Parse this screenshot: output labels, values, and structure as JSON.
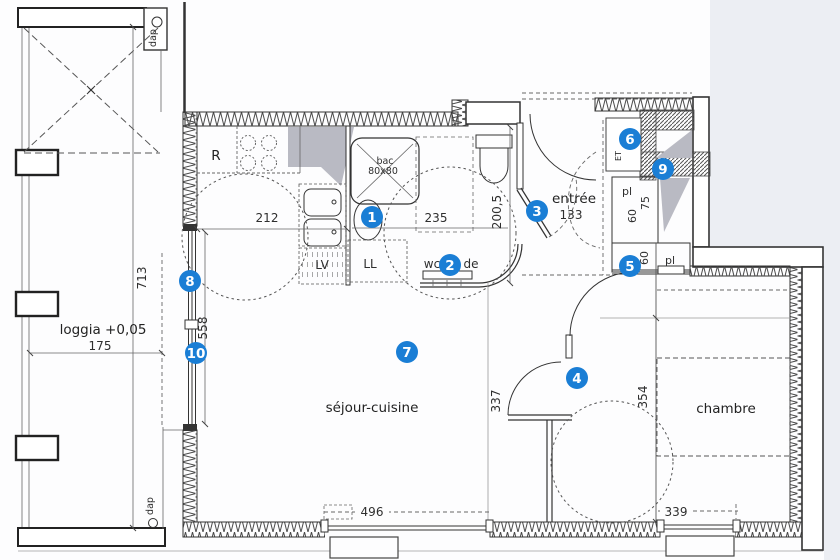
{
  "title": "apartment floor plan with numbered markers",
  "rooms": {
    "sejour_cuisine": "séjour-cuisine",
    "chambre": "chambre",
    "entree": "entrée",
    "entree_dim": "133",
    "loggia": "loggia +0,05",
    "loggia_dim": "175"
  },
  "fixtures": {
    "fridge": "R",
    "shower_line1": "bac",
    "shower_line2": "80x80",
    "dishwasher": "LV",
    "washing_machine": "LL",
    "wc_label_left": "wc",
    "wc_label_right": "de",
    "duct_top": "dap",
    "duct_bottom": "dap",
    "shaft_label": "ET",
    "closet_upper_label": "pl",
    "closet_upper_depth": "75",
    "closet_upper_width": "60",
    "closet_lower_width": "60",
    "closet_lower_label": "pl"
  },
  "dimensions": {
    "kitchen_width": "212",
    "bathroom_width": "235",
    "bathroom_depth": "200,5",
    "loggia_length": "713",
    "glazing_height": "558",
    "sejour_to_wall": "337",
    "chambre_depth": "354",
    "sejour_window": "496",
    "chambre_window": "339"
  },
  "markers": [
    {
      "label": "1"
    },
    {
      "label": "2"
    },
    {
      "label": "3"
    },
    {
      "label": "4"
    },
    {
      "label": "5"
    },
    {
      "label": "6"
    },
    {
      "label": "7"
    },
    {
      "label": "8"
    },
    {
      "label": "9"
    },
    {
      "label": "10"
    }
  ],
  "colors": {
    "marker_blue": "#1a7ed5",
    "wall_line": "#333333",
    "duct_gray": "#b9bac3",
    "outside_tint": "#eceef3"
  }
}
